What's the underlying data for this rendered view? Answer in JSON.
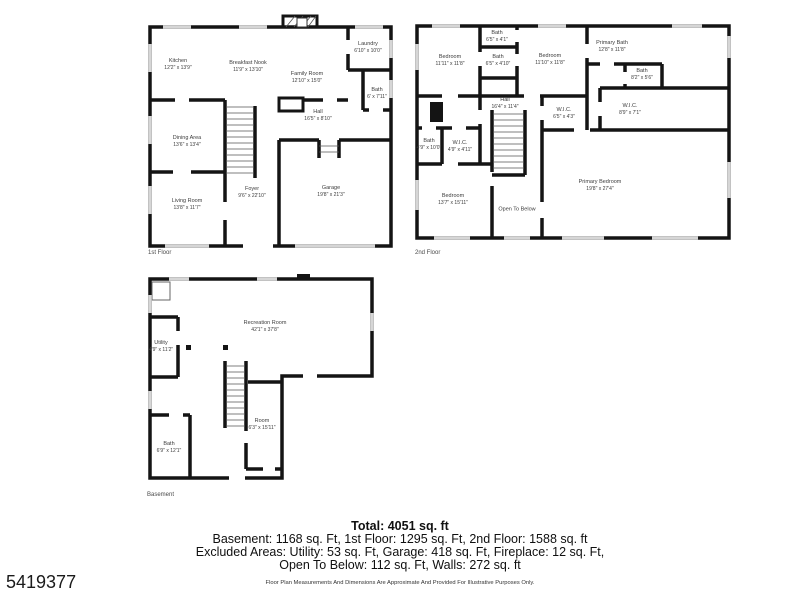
{
  "listing_id": "5419377",
  "summary": {
    "total": "Total: 4051 sq. ft",
    "line1": "Basement: 1168 sq. Ft, 1st Floor: 1295 sq. Ft, 2nd Floor: 1588 sq. ft",
    "line2": "Excluded Areas: Utility: 53 sq. Ft, Garage: 418 sq. Ft, Fireplace: 12 sq. Ft,",
    "line3": "Open To Below: 112 sq. Ft, Walls: 272 sq. ft",
    "disclaimer": "Floor Plan Measurements And Dimensions Are Approximate And Provided For Illustrative Purposes Only."
  },
  "colors": {
    "wall": "#141414",
    "window": "#d6d6d6",
    "label_text": "#3c3c3c"
  },
  "floors": {
    "first": {
      "label": "1st Floor",
      "rooms": {
        "kitchen": {
          "name": "Kitchen",
          "dims": "12'2\" x 13'9\""
        },
        "breakfast_nook": {
          "name": "Breakfast Nook",
          "dims": "11'9\" x 13'10\""
        },
        "family_room": {
          "name": "Family Room",
          "dims": "12'10\" x 15'0\""
        },
        "laundry": {
          "name": "Laundry",
          "dims": "6'10\" x 10'0\""
        },
        "bath": {
          "name": "Bath",
          "dims": "6' x 7'11\""
        },
        "hall": {
          "name": "Hall",
          "dims": "16'5\" x 8'10\""
        },
        "dining_area": {
          "name": "Dining Area",
          "dims": "13'6\" x 13'4\""
        },
        "living_room": {
          "name": "Living Room",
          "dims": "13'8\" x 11'7\""
        },
        "foyer": {
          "name": "Foyer",
          "dims": "9'6\" x 22'10\""
        },
        "garage": {
          "name": "Garage",
          "dims": "19'8\" x 21'3\""
        }
      }
    },
    "second": {
      "label": "2nd Floor",
      "rooms": {
        "bedroom_top_left": {
          "name": "Bedroom",
          "dims": "11'11\" x 11'8\""
        },
        "bath_top": {
          "name": "Bath",
          "dims": "6'5\" x 4'1\""
        },
        "bath_mid": {
          "name": "Bath",
          "dims": "6'5\" x 4'10\""
        },
        "bedroom_top_mid": {
          "name": "Bedroom",
          "dims": "11'10\" x 11'8\""
        },
        "primary_bath": {
          "name": "Primary Bath",
          "dims": "12'8\" x 11'8\""
        },
        "bath_right": {
          "name": "Bath",
          "dims": "8'2\" x 5'6\""
        },
        "hall": {
          "name": "Hall",
          "dims": "16'4\" x 11'4\""
        },
        "wic_small": {
          "name": "W.I.C.",
          "dims": "6'5\" x 4'3\""
        },
        "wic_large": {
          "name": "W.I.C.",
          "dims": "8'9\" x 7'1\""
        },
        "bath_left": {
          "name": "Bath",
          "dims": "4'9\" x 10'0\""
        },
        "wic_left": {
          "name": "W.I.C.",
          "dims": "4'9\" x 4'11\""
        },
        "bedroom_lower_left": {
          "name": "Bedroom",
          "dims": "13'7\" x 15'11\""
        },
        "open_to_below": {
          "name": "Open To Below"
        },
        "primary_bedroom": {
          "name": "Primary Bedroom",
          "dims": "19'8\" x 27'4\""
        }
      }
    },
    "basement": {
      "label": "Basement",
      "rooms": {
        "recreation_room": {
          "name": "Recreation Room",
          "dims": "42'1\" x 37'8\""
        },
        "utility": {
          "name": "Utility",
          "dims": "4'9\" x 11'2\""
        },
        "bath": {
          "name": "Bath",
          "dims": "6'9\" x 12'1\""
        },
        "room": {
          "name": "Room",
          "dims": "6'3\" x 15'11\""
        }
      }
    }
  }
}
